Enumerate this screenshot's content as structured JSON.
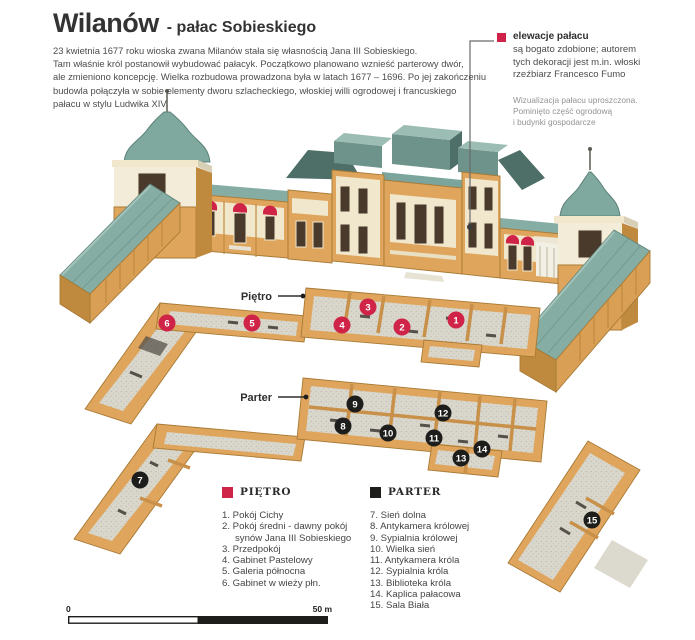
{
  "title": {
    "main": "Wilanów",
    "sub": "- pałac Sobieskiego"
  },
  "intro": "23 kwietnia 1677 roku wioska zwana Milanów stała się własnością Jana III Sobieskiego.\nTam właśnie król postanowił wybudować pałacyk. Początkowo planowano wznieść parterowy dwór,\nale zmieniono koncepcję. Wielka rozbudowa prowadzona była w latach 1677 – 1696. Po jej zakończeniu\nbudowla połączyła w sobie elementy dworu szlacheckiego, włoskiej willi ogrodowej i francuskiego\npałacu w stylu Ludwika XIV.",
  "callout": {
    "title": "elewacje pałacu",
    "body": "są bogato zdobione; autorem\ntych dekoracji jest m.in. włoski\nrzeźbiarz Francesco Fumo"
  },
  "note": "Wizualizacja pałacu uproszczona.\nPominięto część ogrodową\ni budynki gospodarcze",
  "floor_labels": {
    "pietro": "Piętro",
    "parter": "Parter"
  },
  "legend": {
    "pietro": {
      "title": "PIĘTRO",
      "color": "#cf2348",
      "items": [
        {
          "num": "1.",
          "label": "Pokój Cichy"
        },
        {
          "num": "2.",
          "label": "Pokój średni - dawny pokój synów Jana III Sobieskiego"
        },
        {
          "num": "3.",
          "label": "Przedpokój"
        },
        {
          "num": "4.",
          "label": "Gabinet Pastelowy"
        },
        {
          "num": "5.",
          "label": "Galeria północna"
        },
        {
          "num": "6.",
          "label": "Gabinet w wieży płn."
        }
      ]
    },
    "parter": {
      "title": "PARTER",
      "color": "#1d1d1b",
      "items": [
        {
          "num": "7.",
          "label": "Sień dolna"
        },
        {
          "num": "8.",
          "label": "Antykamera królowej"
        },
        {
          "num": "9.",
          "label": "Sypialnia królowej"
        },
        {
          "num": "10.",
          "label": "Wielka sień"
        },
        {
          "num": "11.",
          "label": "Antykamera króla"
        },
        {
          "num": "12.",
          "label": "Sypialnia króla"
        },
        {
          "num": "13.",
          "label": "Biblioteka króla"
        },
        {
          "num": "14.",
          "label": "Kaplica pałacowa"
        },
        {
          "num": "15.",
          "label": "Sala Biała"
        }
      ]
    }
  },
  "markers": {
    "pietro": [
      {
        "n": "1",
        "x": 456,
        "y": 320
      },
      {
        "n": "2",
        "x": 402,
        "y": 327
      },
      {
        "n": "3",
        "x": 368,
        "y": 307
      },
      {
        "n": "4",
        "x": 342,
        "y": 325
      },
      {
        "n": "5",
        "x": 252,
        "y": 323
      },
      {
        "n": "6",
        "x": 167,
        "y": 323
      }
    ],
    "parter": [
      {
        "n": "7",
        "x": 140,
        "y": 480
      },
      {
        "n": "8",
        "x": 343,
        "y": 426
      },
      {
        "n": "9",
        "x": 355,
        "y": 404
      },
      {
        "n": "10",
        "x": 388,
        "y": 433
      },
      {
        "n": "11",
        "x": 434,
        "y": 438
      },
      {
        "n": "12",
        "x": 443,
        "y": 413
      },
      {
        "n": "13",
        "x": 461,
        "y": 458
      },
      {
        "n": "14",
        "x": 482,
        "y": 449
      },
      {
        "n": "15",
        "x": 592,
        "y": 520
      }
    ]
  },
  "scale": {
    "left": "0",
    "right": "50 m"
  },
  "palette": {
    "wall_tan": "#dfa55c",
    "wall_tan_light": "#e9bc7d",
    "wall_tan_dark": "#c08a3e",
    "roof_teal": "#86ada4",
    "roof_teal_light": "#9cbdb4",
    "roof_teal_dark": "#4e6f68",
    "cream": "#f0e7cc",
    "floor_gray": "#d9d6cb",
    "accent_red": "#cf2348",
    "ink": "#1d1d1b"
  }
}
